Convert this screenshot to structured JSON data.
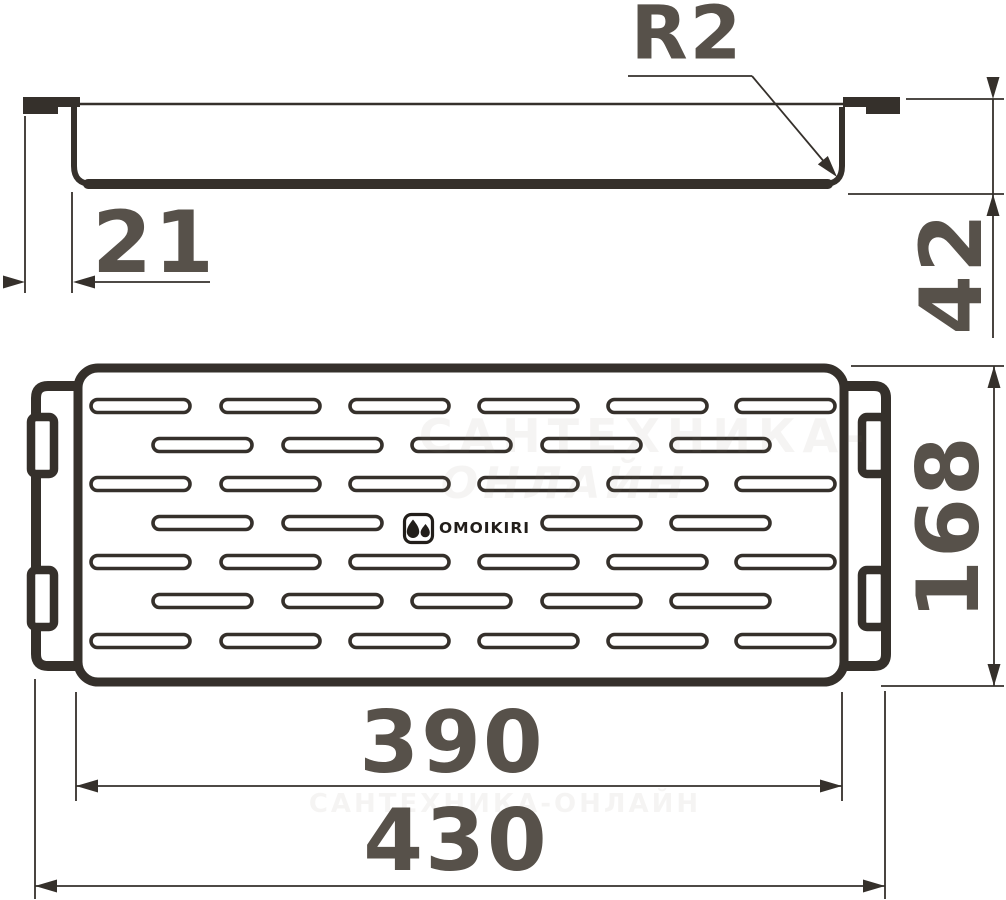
{
  "colors": {
    "line": "#35302b",
    "dim_text": "#57514a",
    "logo": "#221e1a",
    "watermark": "#8a7f72"
  },
  "side_view": {
    "radius_label": "R2",
    "flange_label": "21",
    "height_label": "42"
  },
  "top_view": {
    "slot_area_label": "390",
    "overall_width_label": "430",
    "depth_label": "168"
  },
  "logo": {
    "brand": "OMOIKIRI",
    "icon": "two-water-drops"
  },
  "watermark": {
    "line1": "САНТЕХНИКА-",
    "line2": "ОНЛАЙН",
    "line3": "САНТЕХНИКА-ОНЛАЙН"
  }
}
